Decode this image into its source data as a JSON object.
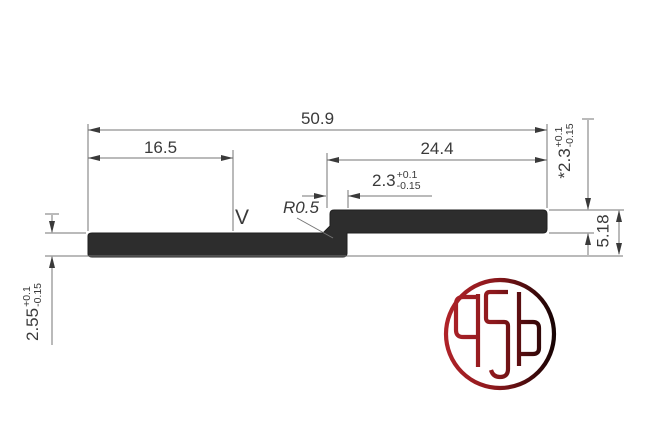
{
  "drawing": {
    "type": "technical-profile-cross-section",
    "dims": {
      "total_width": "50.9",
      "left_segment": "16.5",
      "right_segment": "24.4",
      "overlap": {
        "value": "2.3",
        "tol_plus": "+0.1",
        "tol_minus": "-0.15"
      },
      "right_thickness": {
        "value": "*2.3",
        "tol_plus": "+0.1",
        "tol_minus": "-0.15"
      },
      "step_height": "5.18",
      "left_thickness": {
        "value": "2.55",
        "tol_plus": "+0.1",
        "tol_minus": "-0.15"
      },
      "radius": "R0.5",
      "surface_mark": "V"
    },
    "colors": {
      "profile_fill": "#2d2d2d",
      "dimension_line": "#6f6f6f",
      "text": "#3a3a3a",
      "logo_red": "#aa2327",
      "logo_dark": "#160304"
    }
  },
  "logo": {
    "name": "asa-circular-monogram"
  }
}
